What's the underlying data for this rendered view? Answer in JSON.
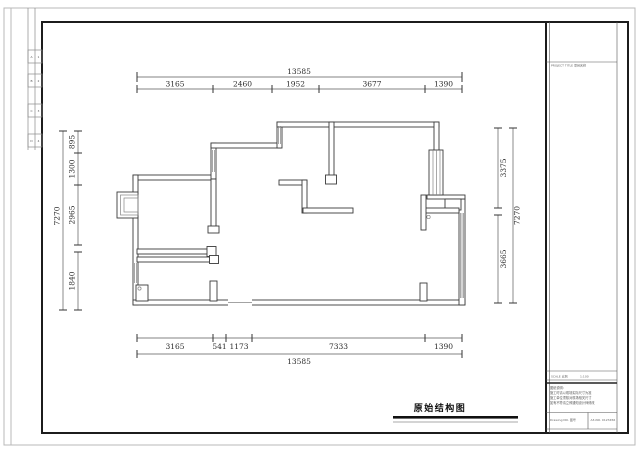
{
  "drawing": {
    "plan_title": "原始结构图",
    "dims": {
      "top_overall": "13585",
      "top_segments": [
        "3165",
        "2460",
        "1952",
        "3677",
        "1390"
      ],
      "bottom_segments": [
        "3165",
        "541",
        "1173",
        "7333",
        "1390"
      ],
      "bottom_overall": "13585",
      "left_overall": "7270",
      "left_segments": [
        "895",
        "1300",
        "2965",
        "1840"
      ],
      "right_overall": "7270",
      "right_segments": [
        "3375",
        "3665"
      ]
    }
  },
  "title_block": {
    "project_label": "PROJECT TITLE 项目名称",
    "scale_label": "SCALE 比例",
    "scale_value": "1:100",
    "notes": {
      "l1": "图纸说明:",
      "l2": "施工时请以现场实际尺寸为准",
      "l3": "施工单位须核对现场相关尺寸",
      "l4": "如有不符请立即通知设计师修改"
    },
    "drawing_no_label": "Drawing NO. 图号",
    "sheet_no": "A3-NO. 0123456"
  },
  "margin_marks": [
    [
      "A",
      "1"
    ],
    [
      "B",
      "2"
    ],
    [
      "C",
      "3"
    ],
    [
      "D",
      "4"
    ]
  ],
  "colors": {
    "frame": "#1c1c1c",
    "wall": "#3a3a3a",
    "dim": "#5a5a5a",
    "border": "#b8b8b8"
  }
}
